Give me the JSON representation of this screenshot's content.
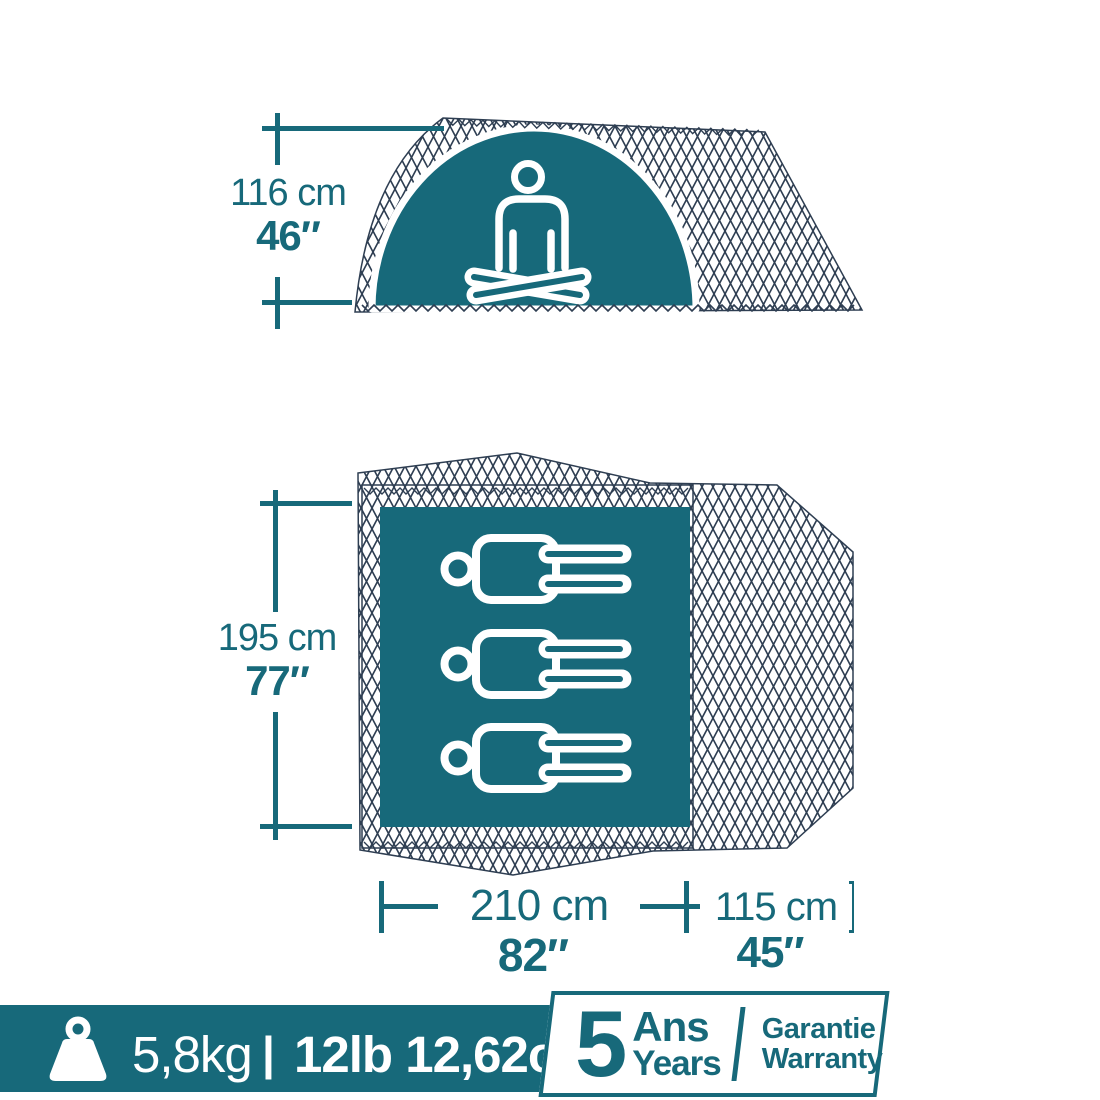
{
  "colors": {
    "teal": "#17697A",
    "mesh_navy": "#2E3E52",
    "white": "#FFFFFF"
  },
  "side_view": {
    "height_metric": "116 cm",
    "height_imperial": "46″"
  },
  "floor_plan": {
    "capacity_persons": 3,
    "length_metric": "195 cm",
    "length_imperial": "77″",
    "width_metric": "210 cm",
    "width_imperial": "82″",
    "vestibule_metric": "115 cm",
    "vestibule_imperial": "45″"
  },
  "banner": {
    "weight_metric": "5,8kg",
    "separator": "|",
    "weight_imperial": "12lb 12,62oz"
  },
  "warranty": {
    "years_value": "5",
    "line1_fr": "Ans",
    "line1_en": "Years",
    "line2_fr": "Garantie",
    "line2_en": "Warranty"
  }
}
